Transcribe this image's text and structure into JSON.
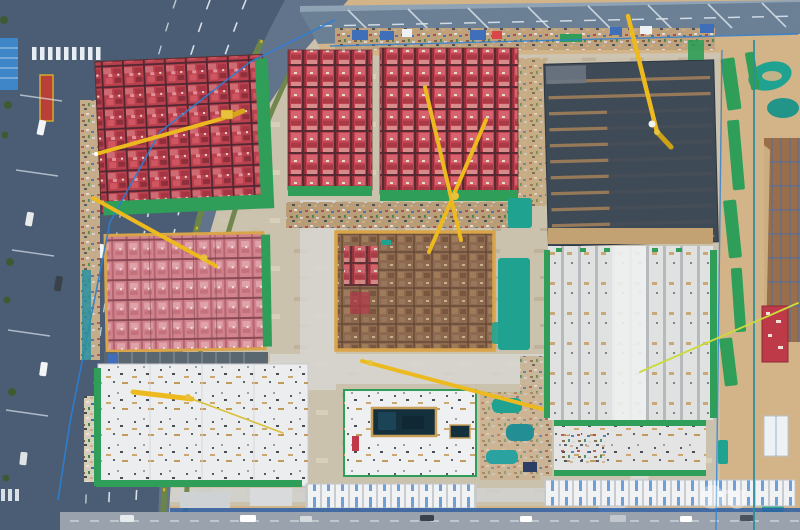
{
  "meta": {
    "type": "aerial-photograph",
    "subject": "Top-down drone photo of a large residential construction site bounded by roads",
    "visible_text": "none (only an illegible faint white watermark at lower right)"
  },
  "palette": {
    "sand": "#d2b488",
    "ground": "#cbc2ae",
    "dirtBrown": "#b08a5a",
    "roadBase": "#62748c",
    "roadDark": "#4b5d75",
    "roadTop": "#6b7f95",
    "sidewalk": "#8fa3b5",
    "laneWhite": "#e4ecf2",
    "medianGreen": "#6b8449",
    "flowerYellow": "#d8b32a",
    "flowerRed": "#b84038",
    "concrete": "#d8d6d1",
    "redA": "#b9414e",
    "redADark": "#4f2631",
    "redC": "#bf4350",
    "pinkE": "#d2848e",
    "darkSlab": "#3f4a57",
    "slabStripe": "#a5825a",
    "brownDeck": "#8d6a4f",
    "deckBorder": "#d9a44a",
    "whiteSlab": "#ecedee",
    "stripeG": "#b7babc",
    "netGreen": "#2e9e58",
    "netTeal": "#1fa390",
    "fenceBlue": "#2b7fd4",
    "fenceTeal": "#2a8fa0",
    "containerBlue": "#3f6fb8",
    "craneYellow": "#ecb91f",
    "craneLime": "#cadb3e",
    "poolDark": "#14303d",
    "poolTrim": "#c9a05a",
    "buildingWhite": "#f0f2f4",
    "doorBlue": "#6e9fd8",
    "bottomRoad": "#9aa3ad",
    "blueBuilding": "#3f86c8",
    "wallBlue": "#2b5fa8",
    "watermarkWhite": "#ffffff"
  },
  "scene": {
    "roads": {
      "left": {
        "label": "multi-lane highway running diagonally down the left side with green planted medians, white lane dashes, zebra crossings and cars"
      },
      "top": {
        "label": "dual-carriageway road along the top edge with leaning light-pole shadows"
      },
      "bottom": {
        "label": "service road along the bottom edge with parked vehicles and white site offices"
      },
      "internal": {
        "label": "light concrete haul roads separating the building plots"
      }
    },
    "blocks": [
      {
        "id": "A",
        "label": "top-left plot: red formwork deck with dark grid, green netting on right/bottom edges, tower crane"
      },
      {
        "id": "B",
        "label": "top-middle small plot: red formwork, green netting bottom edge"
      },
      {
        "id": "C",
        "label": "top-middle large plot: red formwork with two crossed yellow crane jibs"
      },
      {
        "id": "D",
        "label": "top-right plot: dark finished roof slab with horizontal tan stripe rows and crane jib"
      },
      {
        "id": "E",
        "label": "middle-left plot: pink striped formwork with tan border, green netting east edge"
      },
      {
        "id": "F",
        "label": "center plot: brown deck under construction, orange border, red patches at northwest corner"
      },
      {
        "id": "G",
        "label": "middle-right plot: pale slab with vertical stripes and green netting edges"
      },
      {
        "id": "H",
        "label": "bottom-left plot: white foundation slab scattered with materials, green netting west/south edges"
      },
      {
        "id": "I",
        "label": "bottom-center plot: podium slab with dark rectangular pool and small tank, green perimeter"
      },
      {
        "id": "J",
        "label": "landscaped mock-up garden with teal pools east of the pool building"
      },
      {
        "id": "K",
        "label": "bottom-right small slab strip between green netting bands"
      },
      {
        "id": "L",
        "label": "far-right brown plot with blue gridlines beyond the site fence"
      }
    ],
    "cranes": {
      "count": 7,
      "color_name": "yellow",
      "note": "booms seen from directly above as long yellow lines"
    },
    "netting": {
      "label": "bright green and teal safety netting strips along plot edges and over soil stockpiles"
    },
    "fences": {
      "label": "blue and teal site hoarding lines around the perimeter"
    },
    "watermark": {
      "visible": true,
      "legible": false,
      "label": "faint white circular watermark, lower right"
    }
  }
}
